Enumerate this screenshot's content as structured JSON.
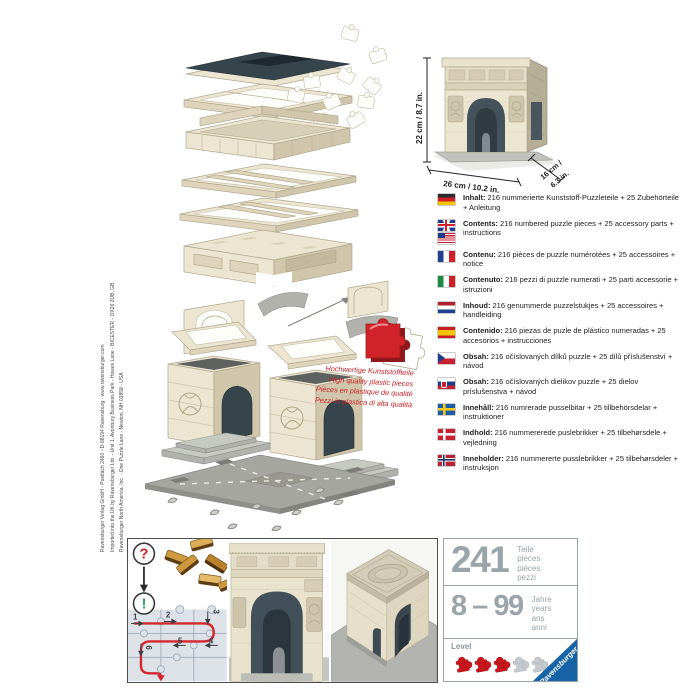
{
  "colors": {
    "brand_red": "#c9161d",
    "brand_blue": "#1664a5",
    "stone_cream": "#ece5d1",
    "slate_dark": "#36444c",
    "number_gray": "#9aa4ab",
    "path_red": "#d3272e",
    "check_green": "#2aa85b"
  },
  "imprint": {
    "lines": [
      "Ravensburger Verlag GmbH - Postfach 2460 - D-88194 Ravensburg - www.ravensburger.com",
      "Imported into the UK by Ravensburger Ltd. - Unit 1, Avonbury Business Park - Howes Lane - BICESTER - OX26 2UB, GB",
      "Ravensburger North America, Inc. - One Puzzle Lane - Newton, NH 03858 - USA"
    ]
  },
  "product_view": {
    "height_label": "22 cm / 8.7 in.",
    "width_label": "26 cm / 10.2 in.",
    "depth_label_line1": "16 cm /",
    "depth_label_line2": "6.3 in."
  },
  "quality_note": {
    "lines": [
      "Hochwertige Kunststoffteile",
      "High quality plastic pieces",
      "Pièces en plastique de qualité",
      "Pezzi in plastica di alta qualità"
    ]
  },
  "contents_list": {
    "items": [
      {
        "flag": "germany",
        "label": "Inhalt:",
        "text": "216 nummerierte Kunststoff-Puzzleteile + 25 Zubehörteile + Anleitung"
      },
      {
        "flag": "uk-usa",
        "label": "Contents:",
        "text": "216 numbered puzzle pieces + 25 accessory parts + instructions"
      },
      {
        "flag": "france",
        "label": "Contenu:",
        "text": "216 pièces de puzzle numérotées + 25 accessoires + notice"
      },
      {
        "flag": "italy",
        "label": "Contenuto:",
        "text": "216 pezzi di puzzle numerati + 25 parti accessorie + istruzioni"
      },
      {
        "flag": "netherlands",
        "label": "Inhoud:",
        "text": "216 genummerde puzzelstukjes + 25 accessoires + handleiding"
      },
      {
        "flag": "spain",
        "label": "Contenido:",
        "text": "216 piezas de puzle de plástico numeradas + 25 accesorios + instrucciones"
      },
      {
        "flag": "czech-republic",
        "label": "Obsah:",
        "text": "216 očíslovaných dílků puzzle + 25 dílů příslušenství + návod"
      },
      {
        "flag": "slovakia",
        "label": "Obsah:",
        "text": "216 očíslovaných dielikov puzzle + 25 dielov príslušenstva + návod"
      },
      {
        "flag": "sweden",
        "label": "Innehåll:",
        "text": "216 numrerade pusselbitar + 25 tillbehörsdelar + instruktioner"
      },
      {
        "flag": "denmark",
        "label": "Indhold:",
        "text": "216 nummererede puslebrikker + 25 tilbehørsdele + vejledning"
      },
      {
        "flag": "norway",
        "label": "Inneholder:",
        "text": "216 nummererte pusslebrikker + 25 tilbehørsdeler + instruksjon"
      }
    ]
  },
  "assembly_panel": {
    "question_mark": "?",
    "exclamation_mark": "!",
    "steps": [
      "1",
      "2",
      "3",
      "4",
      "5",
      "6"
    ]
  },
  "info_panel": {
    "pieces": {
      "value": "241",
      "labels": [
        "Teile",
        "pieces",
        "pièces",
        "pezzi"
      ]
    },
    "age": {
      "value": "8 – 99",
      "labels": [
        "Jahre",
        "years",
        "ans",
        "anni"
      ]
    },
    "level": {
      "label": "Level",
      "filled": 3,
      "total": 5
    },
    "brand": "Ravensburger"
  }
}
